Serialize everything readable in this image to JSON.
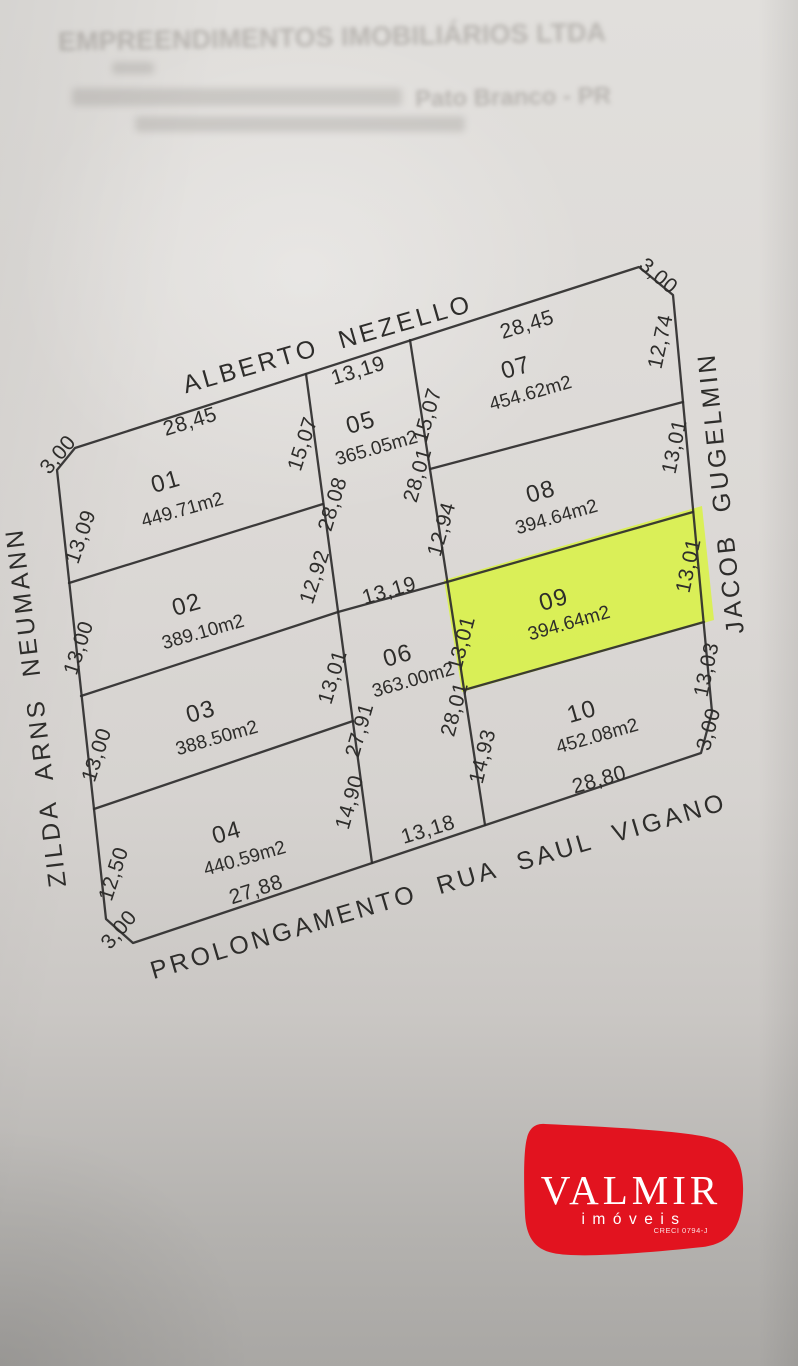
{
  "header": {
    "company": "EMPREENDIMENTOS IMOBILIÁRIOS LTDA",
    "city": "Pato Branco - PR"
  },
  "streets": {
    "top": "ALBERTO NEZELLO",
    "left": "ZILDA ARNS NEUMANN",
    "right": "JACOB GUGELMIN",
    "bottom": "PROLONGAMENTO RUA SAUL VIGANO"
  },
  "lots": [
    {
      "number": "01",
      "area": "449.71m2"
    },
    {
      "number": "02",
      "area": "389.10m2"
    },
    {
      "number": "03",
      "area": "388.50m2"
    },
    {
      "number": "04",
      "area": "440.59m2"
    },
    {
      "number": "05",
      "area": "365.05m2"
    },
    {
      "number": "06",
      "area": "363.00m2"
    },
    {
      "number": "07",
      "area": "454.62m2"
    },
    {
      "number": "08",
      "area": "394.64m2"
    },
    {
      "number": "09",
      "area": "394.64m2"
    },
    {
      "number": "10",
      "area": "452.08m2"
    }
  ],
  "dims": {
    "corner_tl": "3,00",
    "corner_tr": "3,00",
    "corner_br": "3,00",
    "corner_bl": "3,00",
    "lot01_front": "28,45",
    "lot01_left": "13,09",
    "lot01_right": "15,07",
    "lot02_left": "13,00",
    "lot02_right": "12,92",
    "lot03_left": "13,00",
    "lot03_right": "13,01",
    "lot04_left": "12,50",
    "lot04_right": "14,90",
    "lot04_bottom": "27,88",
    "lot05_front": "13,19",
    "lot05_left": "28,08",
    "lot05_right": "28,01",
    "lot06_top": "13,19",
    "lot06_left": "27,91",
    "lot06_right": "28,01",
    "lot06_bottom": "13,18",
    "lot07_front": "28,45",
    "lot07_left": "15,07",
    "lot07_right": "12,74",
    "lot08_left": "12,94",
    "lot08_right": "13,01",
    "lot09_left": "13,01",
    "lot09_right": "13,01",
    "lot10_left": "14,93",
    "lot10_right": "13,03",
    "lot10_bottom": "28,80"
  },
  "highlight": {
    "lot": "09",
    "color": "#d9f43c"
  },
  "logo": {
    "name": "VALMIR",
    "subtitle": "imóveis",
    "creci": "CRECI 0794-J",
    "color": "#e2131f"
  }
}
